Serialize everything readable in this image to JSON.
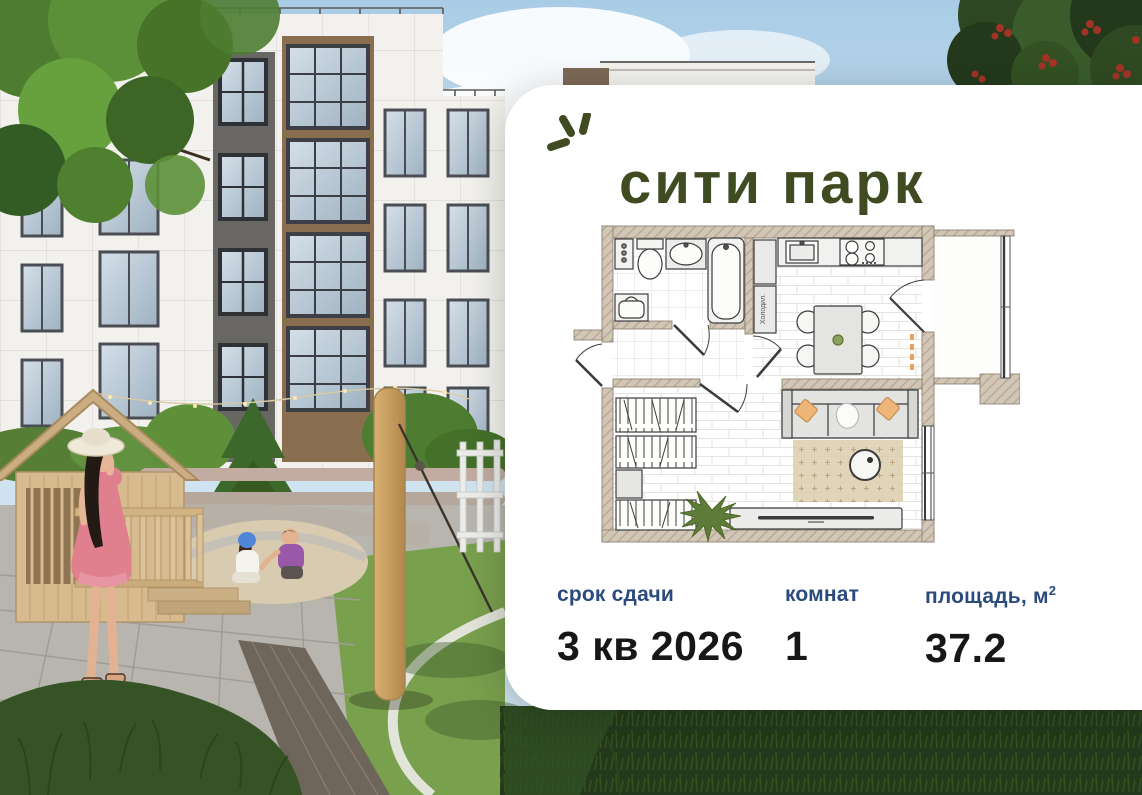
{
  "brand": {
    "logo_text": "сити парк",
    "logo_color": "#414b22",
    "sparkle_icon": "three-rays-sparkle"
  },
  "card": {
    "background": "#ffffff",
    "label_color": "#2b4b7c",
    "value_color": "#171717"
  },
  "stats": {
    "deadline": {
      "label": "срок сдачи",
      "value": "3 кв 2026"
    },
    "rooms": {
      "label": "комнат",
      "value": "1"
    },
    "area": {
      "label": "площадь, м",
      "label_superscript": "2",
      "value": "37.2"
    }
  },
  "floor_plan": {
    "fridge_label": "Холодил.",
    "rooms": [
      "bathroom",
      "hallway",
      "kitchen",
      "living-room",
      "balcony"
    ],
    "furniture_icons": [
      "toilet-icon",
      "washbasin-icon",
      "bathtub-icon",
      "washing-machine-icon",
      "fridge-icon",
      "kitchen-sink-icon",
      "stove-icon",
      "dining-table-icon",
      "chair-icon",
      "wardrobe-shelf-icon",
      "sofa-icon",
      "pillow-icon",
      "rug-icon",
      "coffee-table-icon",
      "tv-console-icon",
      "plant-icon",
      "door-swing-icon",
      "window-icon"
    ],
    "wall_color": "#d2c6b6",
    "pillow_color": "#edb678"
  },
  "photo": {
    "description": "3D rendering of a residential courtyard: apartment building facade, playground with wooden playhouse, woman in pink dress and sun hat, two children playing in sand, lawn, paved paths, rowan tree with red berries",
    "elements": [
      "sky",
      "clouds",
      "building-facade",
      "rowan-berries-tree",
      "tree-foliage",
      "spruce-tree",
      "string-lights",
      "playhouse",
      "woman-figure",
      "child-figures",
      "sand-pit",
      "wooden-pole",
      "zipline-cable",
      "lattice-fence",
      "lawn",
      "pavement",
      "cobble-band",
      "foreground-grass"
    ]
  }
}
